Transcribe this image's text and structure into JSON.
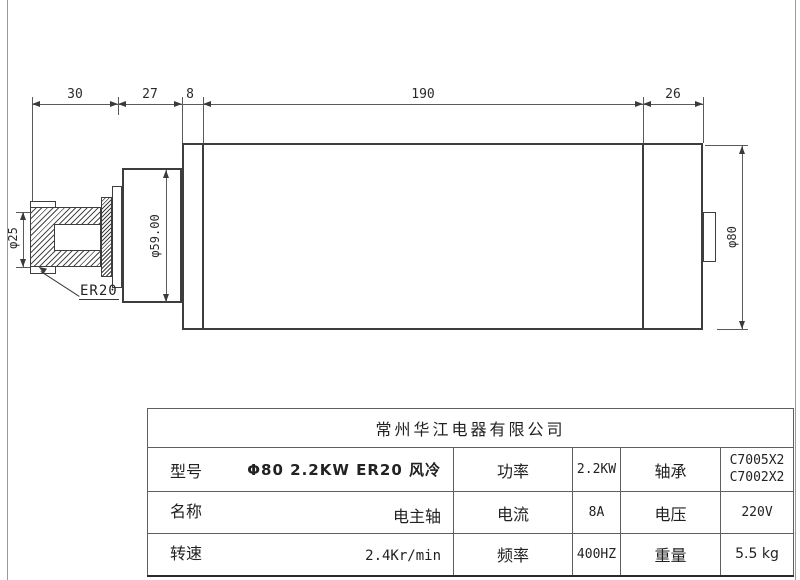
{
  "drawing": {
    "length_dims": {
      "d1": "30",
      "d2": "27",
      "d3": "8",
      "d4": "190",
      "d5": "26"
    },
    "diameter_dims": {
      "shaft": "φ25",
      "flange": "φ59.00",
      "body": "φ80"
    },
    "collet_label": "ER20"
  },
  "table": {
    "company": "常州华江电器有限公司",
    "rows": [
      {
        "label": "型号",
        "value": "Φ80 2.2KW ER20 风冷",
        "param1": "功率",
        "value1": "2.2KW",
        "param2": "轴承",
        "value2": "C7005X2\nC7002X2"
      },
      {
        "label": "名称",
        "value": "电主轴",
        "param1": "电流",
        "value1": "8A",
        "param2": "电压",
        "value2": "220V"
      },
      {
        "label": "转速",
        "value": "2.4Kr/min",
        "param1": "频率",
        "value1": "400HZ",
        "param2": "重量",
        "value2": "5.5 kg"
      }
    ]
  }
}
